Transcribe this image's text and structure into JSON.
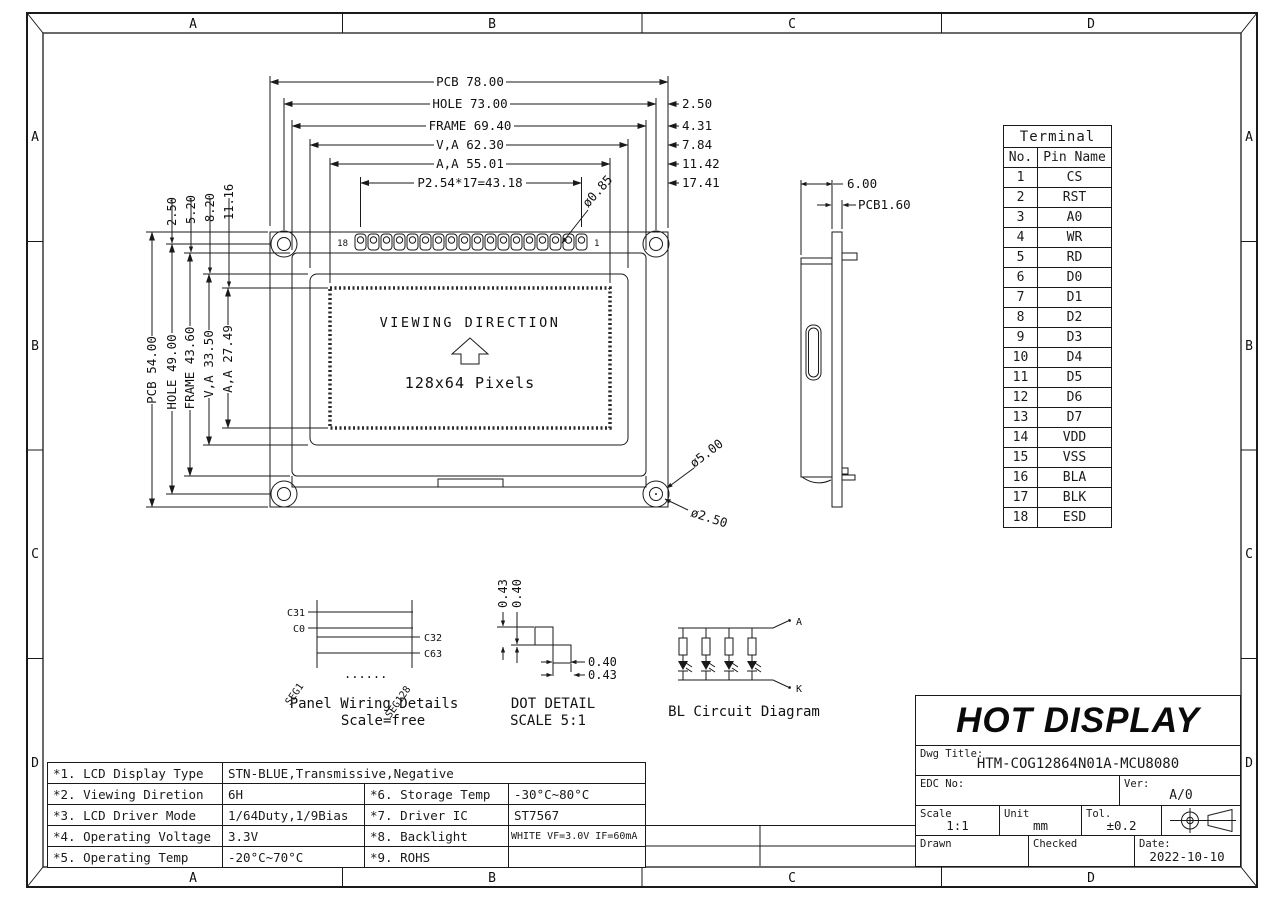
{
  "sheet": {
    "letters": [
      "A",
      "B",
      "C",
      "D"
    ]
  },
  "front_view": {
    "dim_pcb_w": "PCB 78.00",
    "dim_hole_w": "HOLE 73.00",
    "dim_frame_w": "FRAME 69.40",
    "dim_va_w": "V,A 62.30",
    "dim_aa_w": "A,A 55.01",
    "dim_pitch": "P2.54*17=43.18",
    "offsets": [
      "2.50",
      "4.31",
      "7.84",
      "11.42",
      "17.41"
    ],
    "dim_pin_dia": "ø0.85",
    "small_dims": [
      "2.50",
      "5.20",
      "8.20",
      "11.16"
    ],
    "dim_pcb_h": "PCB 54.00",
    "dim_hole_h": "HOLE 49.00",
    "dim_frame_h": "FRAME 43.60",
    "dim_va_h": "V,A 33.50",
    "dim_aa_h": "A,A 27.49",
    "viewing_direction": "VIEWING DIRECTION",
    "pixels": "128x64 Pixels",
    "pin_last": "18",
    "pin_first": "1",
    "dim_hole_outer": "ø5.00",
    "dim_hole_inner": "ø2.50"
  },
  "side_view": {
    "dim_thickness": "6.00",
    "dim_pcb": "PCB1.60"
  },
  "terminal_table": {
    "title": "Terminal",
    "col_no": "No.",
    "col_pin": "Pin Name",
    "rows": [
      [
        "1",
        "CS"
      ],
      [
        "2",
        "RST"
      ],
      [
        "3",
        "A0"
      ],
      [
        "4",
        "WR"
      ],
      [
        "5",
        "RD"
      ],
      [
        "6",
        "D0"
      ],
      [
        "7",
        "D1"
      ],
      [
        "8",
        "D2"
      ],
      [
        "9",
        "D3"
      ],
      [
        "10",
        "D4"
      ],
      [
        "11",
        "D5"
      ],
      [
        "12",
        "D6"
      ],
      [
        "13",
        "D7"
      ],
      [
        "14",
        "VDD"
      ],
      [
        "15",
        "VSS"
      ],
      [
        "16",
        "BLA"
      ],
      [
        "17",
        "BLK"
      ],
      [
        "18",
        "ESD"
      ]
    ]
  },
  "wiring": {
    "c31": "C31",
    "c0": "C0",
    "c32": "C32",
    "c63": "C63",
    "seg1": "SEG1",
    "seg128": "SEG128",
    "dots": "......",
    "caption1": "Panel Wiring Details",
    "caption2": "Scale=free"
  },
  "dot_detail": {
    "v1": "0.43",
    "v2": "0.40",
    "h1": "0.40",
    "h2": "0.43",
    "caption1": "DOT DETAIL",
    "caption2": "SCALE 5:1"
  },
  "bl_circuit": {
    "a": "A",
    "k": "K",
    "caption": "BL Circuit Diagram"
  },
  "spec_table": {
    "rows": [
      {
        "l": "*1. LCD Display Type",
        "v": "STN-BLUE,Transmissive,Negative"
      },
      {
        "l": "*2. Viewing Diretion",
        "v": "6H",
        "l2": "*6. Storage Temp",
        "v2": "-30°C~80°C"
      },
      {
        "l": "*3. LCD Driver Mode",
        "v": "1/64Duty,1/9Bias",
        "l2": "*7. Driver IC",
        "v2": "ST7567"
      },
      {
        "l": "*4. Operating Voltage",
        "v": "3.3V",
        "l2": "*8. Backlight",
        "v2": "WHITE VF=3.0V IF=60mA"
      },
      {
        "l": "*5. Operating Temp",
        "v": "-20°C~70°C",
        "l2": "*9. ROHS",
        "v2": ""
      }
    ]
  },
  "title_block": {
    "brand": "HOT DISPLAY",
    "dwg_label": "Dwg Title:",
    "dwg_value": "HTM-COG12864N01A-MCU8080",
    "edc_label": "EDC No:",
    "ver_label": "Ver:",
    "ver_value": "A/0",
    "scale_label": "Scale",
    "scale_value": "1:1",
    "unit_label": "Unit",
    "unit_value": "mm",
    "tol_label": "Tol.",
    "tol_value": "±0.2",
    "drawn_label": "Drawn",
    "checked_label": "Checked",
    "date_label": "Date:",
    "date_value": "2022-10-10"
  }
}
